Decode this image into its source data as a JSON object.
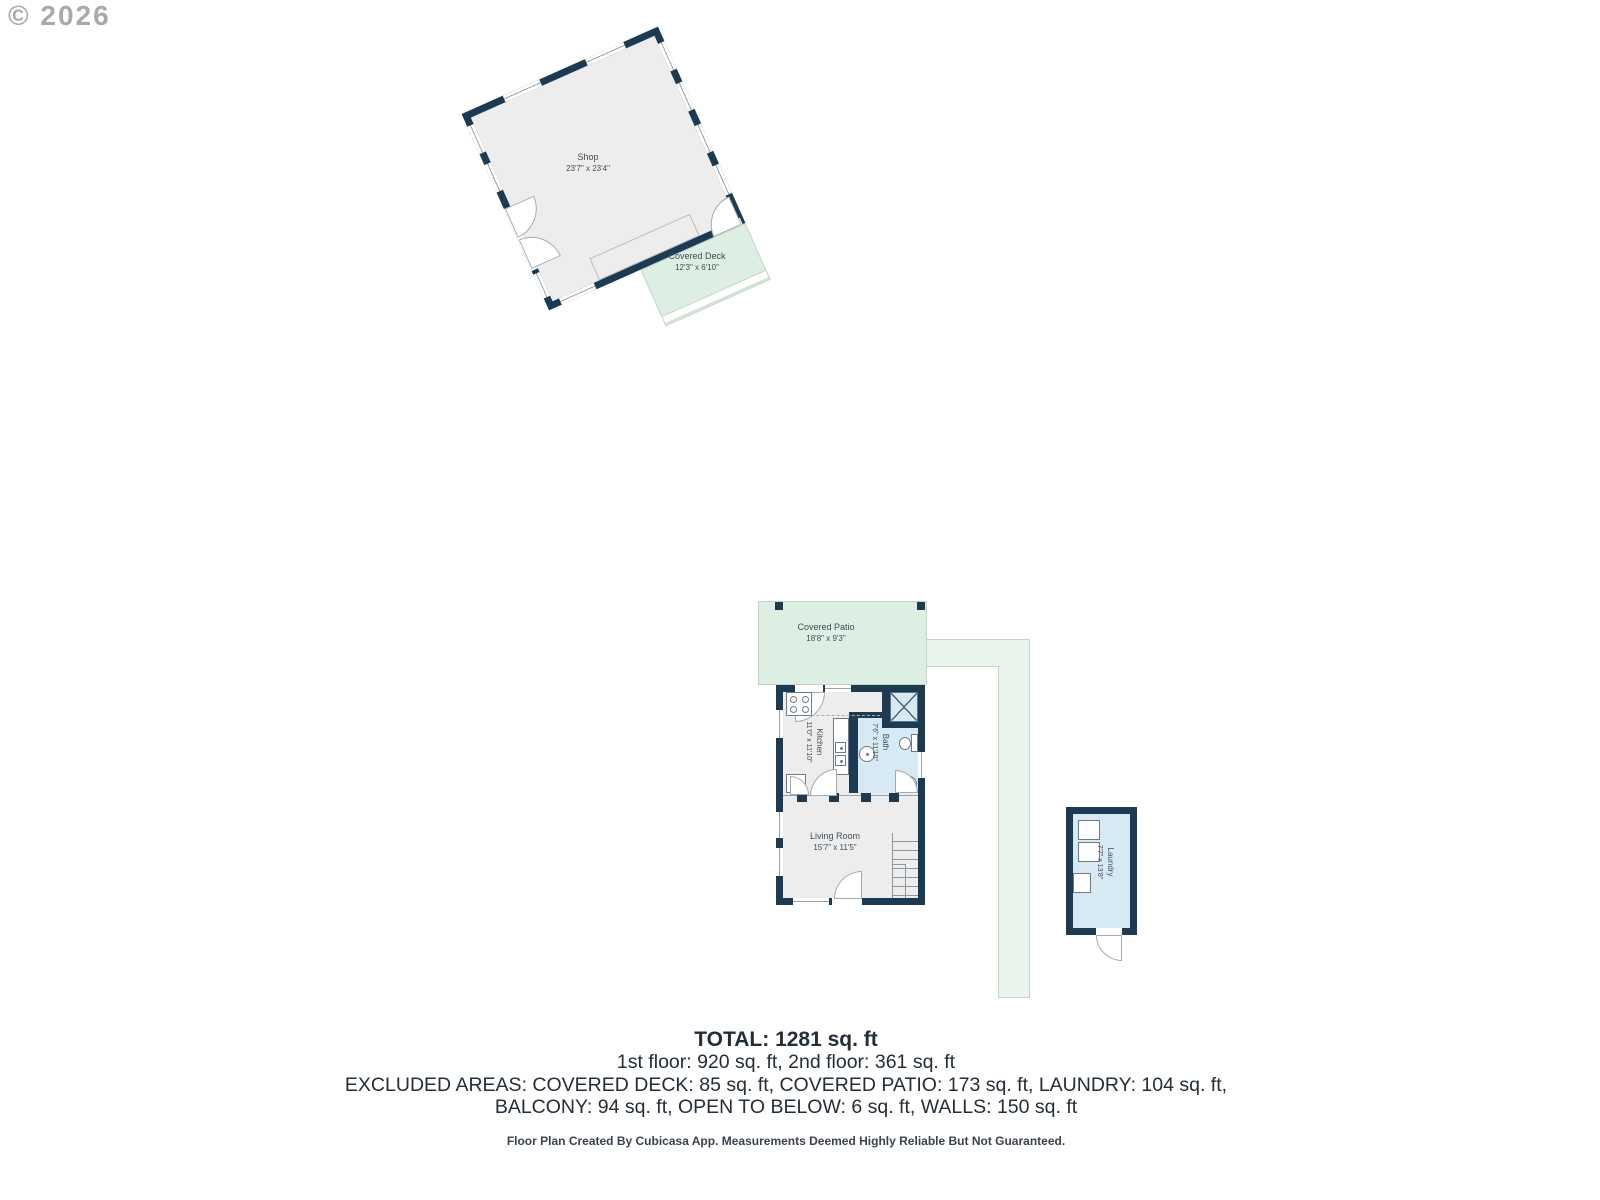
{
  "watermark": "© 2026",
  "rooms": {
    "shop": {
      "name": "Shop",
      "dims": "23'7\" x 23'4\""
    },
    "covered_deck": {
      "name": "Covered Deck",
      "dims": "12'3\" x 6'10\""
    },
    "covered_patio": {
      "name": "Covered Patio",
      "dims": "18'8\" x 9'3\""
    },
    "kitchen": {
      "name": "Kitchen",
      "dims": "11'0\" x 11'10\""
    },
    "bath": {
      "name": "Bath",
      "dims": "7'6\" x 11'10\""
    },
    "living_room": {
      "name": "Living Room",
      "dims": "15'7\" x 11'5\""
    },
    "laundry": {
      "name": "Laundry",
      "dims": "7'7\" x 13'8\""
    }
  },
  "summary": {
    "total": "TOTAL: 1281 sq. ft",
    "floors": "1st floor: 920 sq. ft, 2nd floor: 361 sq. ft",
    "excluded_line1": "EXCLUDED AREAS: COVERED DECK: 85 sq. ft, COVERED PATIO: 173 sq. ft, LAUNDRY: 104 sq. ft,",
    "excluded_line2": "BALCONY: 94 sq. ft, OPEN TO BELOW: 6 sq. ft, WALLS: 150 sq. ft",
    "disclaimer": "Floor Plan Created By Cubicasa App. Measurements Deemed Highly Reliable But Not Guaranteed."
  },
  "colors": {
    "wall": "#1c3a52",
    "room_fill": "#ededed",
    "outdoor_green": "#ddeee3",
    "walkway_green": "#e9f4ec",
    "wet_room_blue": "#d7eaf4"
  }
}
